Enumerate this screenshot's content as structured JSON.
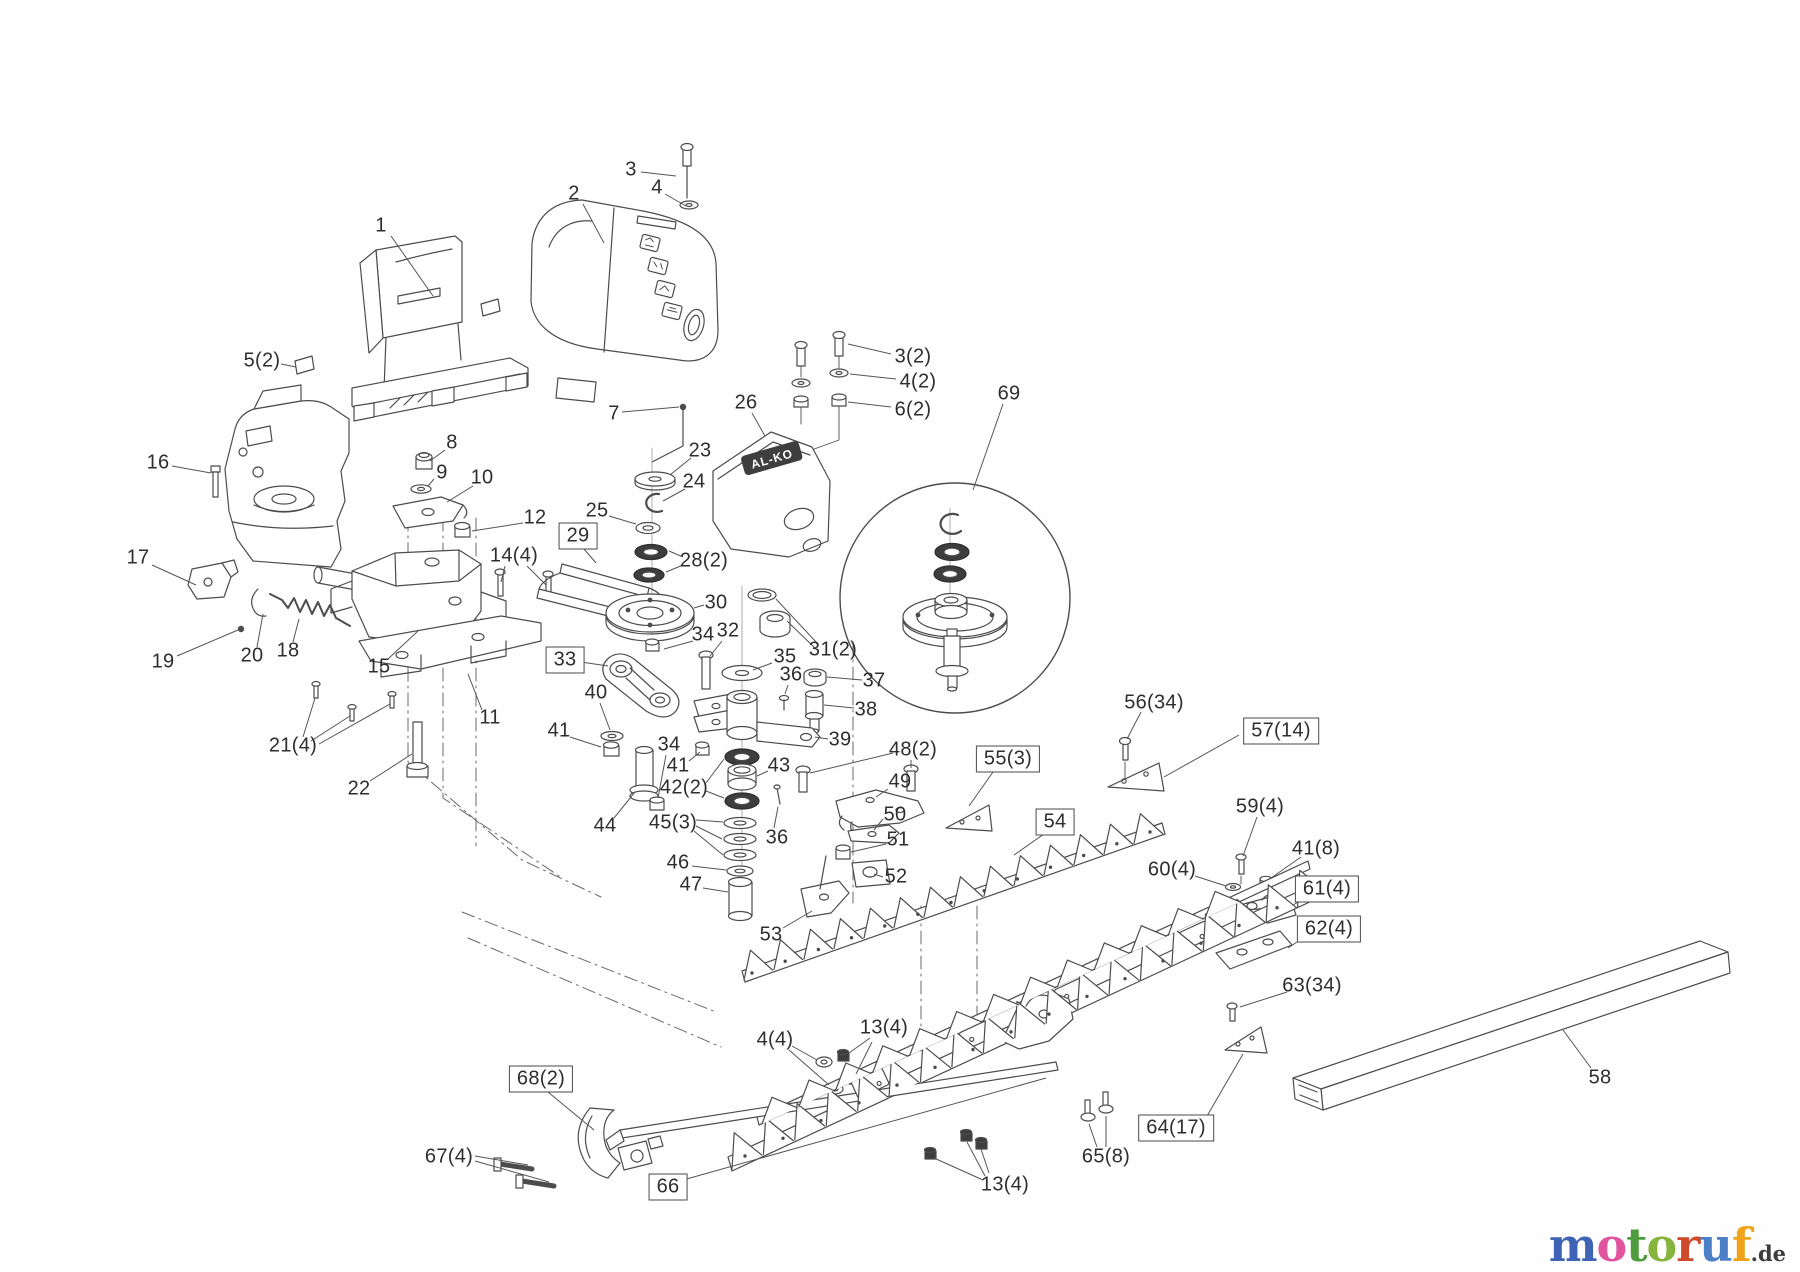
{
  "brand_plate": {
    "text": "AL-KO"
  },
  "watermark": {
    "letters": [
      {
        "ch": "m",
        "color": "#3f63b5"
      },
      {
        "ch": "o",
        "color": "#e0559e"
      },
      {
        "ch": "t",
        "color": "#4f9c3f"
      },
      {
        "ch": "o",
        "color": "#86b43c"
      },
      {
        "ch": "r",
        "color": "#cf4a2a"
      },
      {
        "ch": "u",
        "color": "#4d7fc6"
      },
      {
        "ch": "f",
        "color": "#f0a318"
      }
    ],
    "suffix": ".de",
    "suffix_color": "#3c3c3c"
  },
  "labels": [
    {
      "t": "1",
      "x": 381,
      "y": 226,
      "leads": [
        [
          391,
          236,
          433,
          296
        ]
      ]
    },
    {
      "t": "2",
      "x": 574,
      "y": 194,
      "leads": [
        [
          583,
          204,
          604,
          243
        ]
      ]
    },
    {
      "t": "3",
      "x": 631,
      "y": 170,
      "leads": [
        [
          641,
          172,
          676,
          176
        ]
      ]
    },
    {
      "t": "4",
      "x": 657,
      "y": 188,
      "leads": [
        [
          665,
          194,
          686,
          206
        ]
      ]
    },
    {
      "t": "5(2)",
      "x": 262,
      "y": 361,
      "leads": [
        [
          281,
          364,
          296,
          367
        ]
      ]
    },
    {
      "t": "7",
      "x": 614,
      "y": 414,
      "leads": [
        [
          622,
          412,
          679,
          407
        ]
      ]
    },
    {
      "t": "26",
      "x": 746,
      "y": 403,
      "leads": [
        [
          752,
          413,
          765,
          436
        ]
      ]
    },
    {
      "t": "3(2)",
      "x": 913,
      "y": 357,
      "leads": [
        [
          891,
          354,
          848,
          344
        ]
      ]
    },
    {
      "t": "4(2)",
      "x": 918,
      "y": 382,
      "leads": [
        [
          896,
          379,
          850,
          374
        ]
      ]
    },
    {
      "t": "6(2)",
      "x": 913,
      "y": 410,
      "leads": [
        [
          891,
          407,
          848,
          402
        ]
      ]
    },
    {
      "t": "69",
      "x": 1009,
      "y": 394,
      "leads": [
        [
          1003,
          404,
          973,
          490
        ]
      ]
    },
    {
      "t": "16",
      "x": 158,
      "y": 463,
      "leads": [
        [
          172,
          466,
          211,
          473
        ]
      ]
    },
    {
      "t": "8",
      "x": 452,
      "y": 443,
      "leads": [
        [
          445,
          450,
          430,
          461
        ]
      ]
    },
    {
      "t": "9",
      "x": 442,
      "y": 473,
      "leads": [
        [
          434,
          479,
          428,
          486
        ]
      ]
    },
    {
      "t": "10",
      "x": 482,
      "y": 478,
      "leads": [
        [
          473,
          486,
          447,
          502
        ]
      ]
    },
    {
      "t": "23",
      "x": 700,
      "y": 451,
      "leads": [
        [
          691,
          458,
          670,
          475
        ]
      ]
    },
    {
      "t": "24",
      "x": 694,
      "y": 482,
      "leads": [
        [
          685,
          489,
          663,
          501
        ]
      ]
    },
    {
      "t": "25",
      "x": 597,
      "y": 511,
      "leads": [
        [
          609,
          516,
          636,
          524
        ]
      ]
    },
    {
      "t": "12",
      "x": 535,
      "y": 518,
      "leads": [
        [
          523,
          523,
          472,
          531
        ]
      ]
    },
    {
      "t": "29",
      "x": 578,
      "y": 536,
      "boxed": true,
      "leads": [
        [
          584,
          549,
          596,
          563
        ]
      ]
    },
    {
      "t": "28(2)",
      "x": 704,
      "y": 561,
      "leads": [
        [
          683,
          557,
          669,
          551
        ],
        [
          683,
          565,
          666,
          572
        ]
      ]
    },
    {
      "t": "17",
      "x": 138,
      "y": 558,
      "leads": [
        [
          152,
          565,
          196,
          585
        ]
      ]
    },
    {
      "t": "14(4)",
      "x": 514,
      "y": 556,
      "leads": [
        [
          505,
          566,
          501,
          582
        ],
        [
          527,
          566,
          546,
          585
        ]
      ]
    },
    {
      "t": "30",
      "x": 716,
      "y": 603,
      "leads": [
        [
          704,
          605,
          694,
          608
        ]
      ]
    },
    {
      "t": "34",
      "x": 703,
      "y": 635,
      "leads": [
        [
          693,
          641,
          664,
          649
        ]
      ]
    },
    {
      "t": "32",
      "x": 728,
      "y": 631,
      "leads": [
        [
          722,
          641,
          710,
          656
        ]
      ]
    },
    {
      "t": "31(2)",
      "x": 833,
      "y": 650,
      "leads": [
        [
          817,
          643,
          776,
          599
        ],
        [
          817,
          650,
          787,
          621
        ]
      ]
    },
    {
      "t": "18",
      "x": 288,
      "y": 651,
      "leads": [
        [
          293,
          642,
          299,
          619
        ]
      ]
    },
    {
      "t": "20",
      "x": 252,
      "y": 656,
      "leads": [
        [
          257,
          647,
          263,
          614
        ]
      ]
    },
    {
      "t": "19",
      "x": 163,
      "y": 662,
      "leads": [
        [
          177,
          656,
          238,
          630
        ]
      ]
    },
    {
      "t": "15",
      "x": 379,
      "y": 667,
      "leads": [
        [
          388,
          659,
          418,
          631
        ]
      ]
    },
    {
      "t": "33",
      "x": 565,
      "y": 660,
      "boxed": true,
      "leads": [
        [
          581,
          662,
          608,
          666
        ]
      ]
    },
    {
      "t": "35",
      "x": 785,
      "y": 657,
      "leads": [
        [
          772,
          663,
          753,
          670
        ]
      ]
    },
    {
      "t": "36",
      "x": 791,
      "y": 675,
      "leads": [
        [
          788,
          685,
          785,
          694
        ]
      ]
    },
    {
      "t": "37",
      "x": 874,
      "y": 681,
      "leads": [
        [
          862,
          680,
          827,
          677
        ]
      ]
    },
    {
      "t": "38",
      "x": 866,
      "y": 710,
      "leads": [
        [
          854,
          708,
          824,
          705
        ]
      ]
    },
    {
      "t": "40",
      "x": 596,
      "y": 693,
      "leads": [
        [
          600,
          703,
          610,
          730
        ]
      ]
    },
    {
      "t": "41",
      "x": 559,
      "y": 731,
      "leads": [
        [
          570,
          737,
          601,
          747
        ]
      ]
    },
    {
      "t": "34",
      "x": 669,
      "y": 745,
      "leads": [
        [
          666,
          755,
          658,
          798
        ]
      ]
    },
    {
      "t": "39",
      "x": 840,
      "y": 740,
      "leads": [
        [
          828,
          739,
          815,
          737
        ]
      ]
    },
    {
      "t": "21(4)",
      "x": 293,
      "y": 746,
      "leads": [
        [
          303,
          737,
          315,
          698
        ],
        [
          311,
          741,
          350,
          716
        ],
        [
          319,
          744,
          390,
          704
        ]
      ]
    },
    {
      "t": "11",
      "x": 490,
      "y": 718,
      "leads": [
        [
          482,
          710,
          468,
          674
        ]
      ]
    },
    {
      "t": "41",
      "x": 678,
      "y": 766,
      "leads": [
        [
          689,
          761,
          700,
          752
        ]
      ]
    },
    {
      "t": "42(2)",
      "x": 684,
      "y": 788,
      "leads": [
        [
          706,
          783,
          724,
          759
        ],
        [
          706,
          791,
          724,
          798
        ]
      ]
    },
    {
      "t": "43",
      "x": 779,
      "y": 766,
      "leads": [
        [
          768,
          771,
          757,
          776
        ]
      ]
    },
    {
      "t": "22",
      "x": 359,
      "y": 789,
      "leads": [
        [
          370,
          781,
          412,
          754
        ]
      ]
    },
    {
      "t": "44",
      "x": 605,
      "y": 826,
      "leads": [
        [
          614,
          818,
          635,
          792
        ]
      ]
    },
    {
      "t": "45(3)",
      "x": 673,
      "y": 823,
      "leads": [
        [
          696,
          820,
          723,
          822
        ],
        [
          696,
          826,
          722,
          839
        ],
        [
          694,
          831,
          723,
          855
        ]
      ]
    },
    {
      "t": "36",
      "x": 777,
      "y": 838,
      "leads": [
        [
          774,
          828,
          778,
          807
        ]
      ]
    },
    {
      "t": "46",
      "x": 678,
      "y": 863,
      "leads": [
        [
          692,
          866,
          726,
          870
        ]
      ]
    },
    {
      "t": "47",
      "x": 691,
      "y": 885,
      "leads": [
        [
          703,
          888,
          728,
          892
        ]
      ]
    },
    {
      "t": "48(2)",
      "x": 913,
      "y": 750,
      "leads": [
        [
          911,
          760,
          911,
          768
        ],
        [
          893,
          753,
          810,
          773
        ]
      ]
    },
    {
      "t": "49",
      "x": 900,
      "y": 782,
      "leads": [
        [
          888,
          789,
          876,
          797
        ]
      ]
    },
    {
      "t": "50",
      "x": 895,
      "y": 815,
      "leads": [
        [
          883,
          819,
          874,
          830
        ]
      ]
    },
    {
      "t": "51",
      "x": 898,
      "y": 840,
      "leads": [
        [
          886,
          844,
          851,
          852
        ]
      ]
    },
    {
      "t": "52",
      "x": 896,
      "y": 877,
      "leads": [
        [
          883,
          877,
          874,
          874
        ]
      ]
    },
    {
      "t": "53",
      "x": 771,
      "y": 935,
      "leads": [
        [
          783,
          928,
          812,
          911
        ]
      ]
    },
    {
      "t": "55(3)",
      "x": 1008,
      "y": 759,
      "boxed": true,
      "leads": [
        [
          993,
          772,
          969,
          806
        ]
      ]
    },
    {
      "t": "54",
      "x": 1055,
      "y": 822,
      "boxed": true,
      "leads": [
        [
          1044,
          834,
          1014,
          855
        ]
      ]
    },
    {
      "t": "56(34)",
      "x": 1154,
      "y": 703,
      "leads": [
        [
          1141,
          712,
          1127,
          739
        ]
      ]
    },
    {
      "t": "57(14)",
      "x": 1281,
      "y": 731,
      "boxed": true,
      "leads": [
        [
          1239,
          735,
          1164,
          777
        ]
      ]
    },
    {
      "t": "59(4)",
      "x": 1260,
      "y": 807,
      "leads": [
        [
          1257,
          817,
          1243,
          856
        ]
      ]
    },
    {
      "t": "41(8)",
      "x": 1316,
      "y": 849,
      "leads": [
        [
          1301,
          857,
          1271,
          878
        ]
      ]
    },
    {
      "t": "60(4)",
      "x": 1172,
      "y": 870,
      "leads": [
        [
          1195,
          876,
          1226,
          886
        ]
      ]
    },
    {
      "t": "61(4)",
      "x": 1327,
      "y": 889,
      "boxed": true,
      "leads": [
        [
          1305,
          898,
          1293,
          905
        ]
      ]
    },
    {
      "t": "62(4)",
      "x": 1329,
      "y": 929,
      "boxed": true,
      "leads": [
        [
          1303,
          938,
          1288,
          948
        ]
      ]
    },
    {
      "t": "63(34)",
      "x": 1312,
      "y": 986,
      "leads": [
        [
          1287,
          992,
          1240,
          1007
        ]
      ]
    },
    {
      "t": "58",
      "x": 1600,
      "y": 1078,
      "leads": [
        [
          1591,
          1068,
          1563,
          1030
        ]
      ]
    },
    {
      "t": "64(17)",
      "x": 1176,
      "y": 1128,
      "boxed": true,
      "leads": [
        [
          1207,
          1116,
          1243,
          1054
        ]
      ]
    },
    {
      "t": "65(8)",
      "x": 1106,
      "y": 1157,
      "leads": [
        [
          1097,
          1147,
          1089,
          1124
        ],
        [
          1106,
          1147,
          1106,
          1116
        ]
      ]
    },
    {
      "t": "4(4)",
      "x": 775,
      "y": 1040,
      "leads": [
        [
          792,
          1046,
          817,
          1060
        ],
        [
          789,
          1050,
          829,
          1085
        ]
      ]
    },
    {
      "t": "13(4)",
      "x": 884,
      "y": 1028,
      "leads": [
        [
          870,
          1038,
          849,
          1053
        ],
        [
          872,
          1042,
          856,
          1074
        ]
      ]
    },
    {
      "t": "13(4)",
      "x": 1005,
      "y": 1185,
      "leads": [
        [
          983,
          1180,
          934,
          1158
        ],
        [
          985,
          1176,
          967,
          1142
        ],
        [
          989,
          1173,
          981,
          1149
        ]
      ]
    },
    {
      "t": "66",
      "x": 668,
      "y": 1187,
      "boxed": true,
      "leads": [
        [
          683,
          1180,
          1046,
          1078
        ]
      ]
    },
    {
      "t": "67(4)",
      "x": 449,
      "y": 1157,
      "leads": [
        [
          475,
          1156,
          528,
          1165
        ],
        [
          475,
          1161,
          549,
          1182
        ]
      ]
    },
    {
      "t": "68(2)",
      "x": 541,
      "y": 1079,
      "boxed": true,
      "leads": [
        [
          548,
          1092,
          594,
          1130
        ]
      ]
    }
  ]
}
